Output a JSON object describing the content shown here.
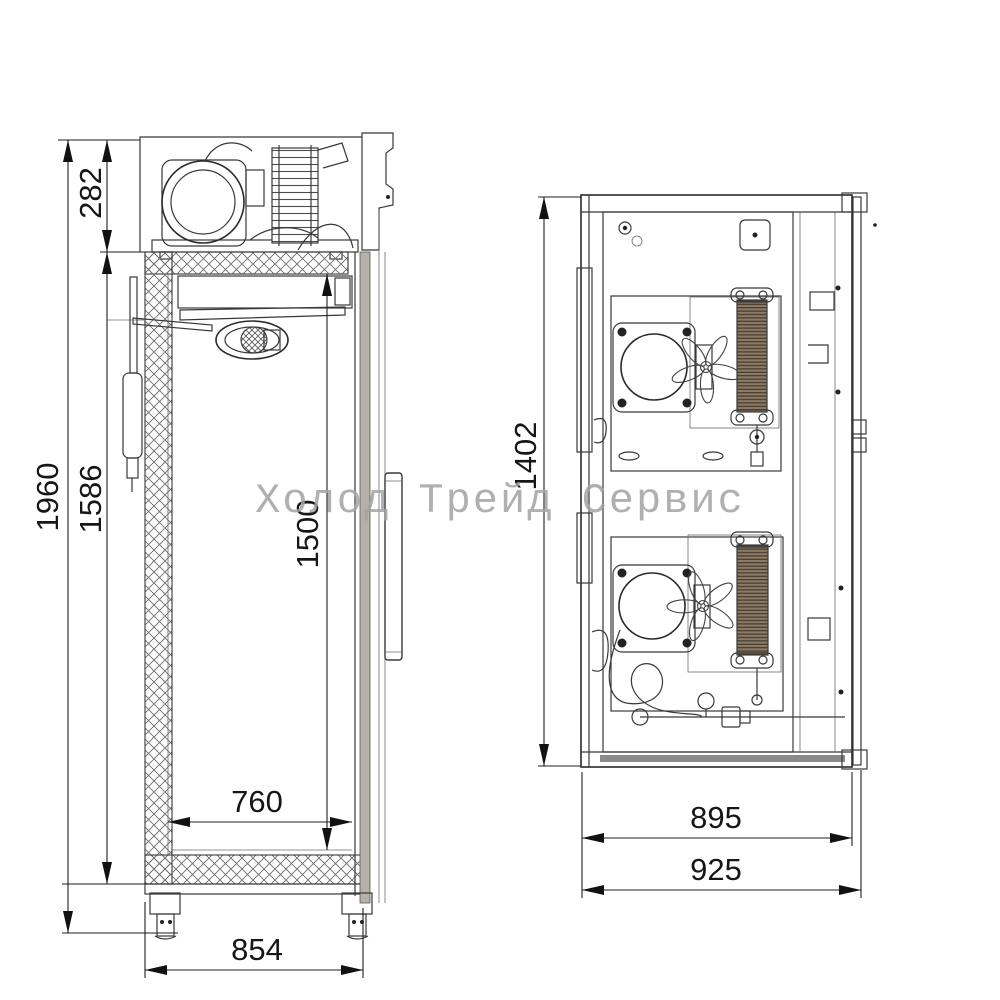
{
  "watermark": {
    "text": "Холод Трейд Сервис"
  },
  "side_view": {
    "dim_overall_height": "1960",
    "dim_insulated_height": "1586",
    "dim_machinery_height": "282",
    "dim_interior_height": "1500",
    "dim_interior_depth": "760",
    "dim_overall_depth": "854"
  },
  "top_view": {
    "dim_width": "1402",
    "dim_depth_body": "895",
    "dim_depth_overall": "925"
  },
  "colors": {
    "line": "#383838",
    "dim_text": "#161616",
    "watermark": "#a3a3a3",
    "condenser_fill": "#8b7b64"
  }
}
